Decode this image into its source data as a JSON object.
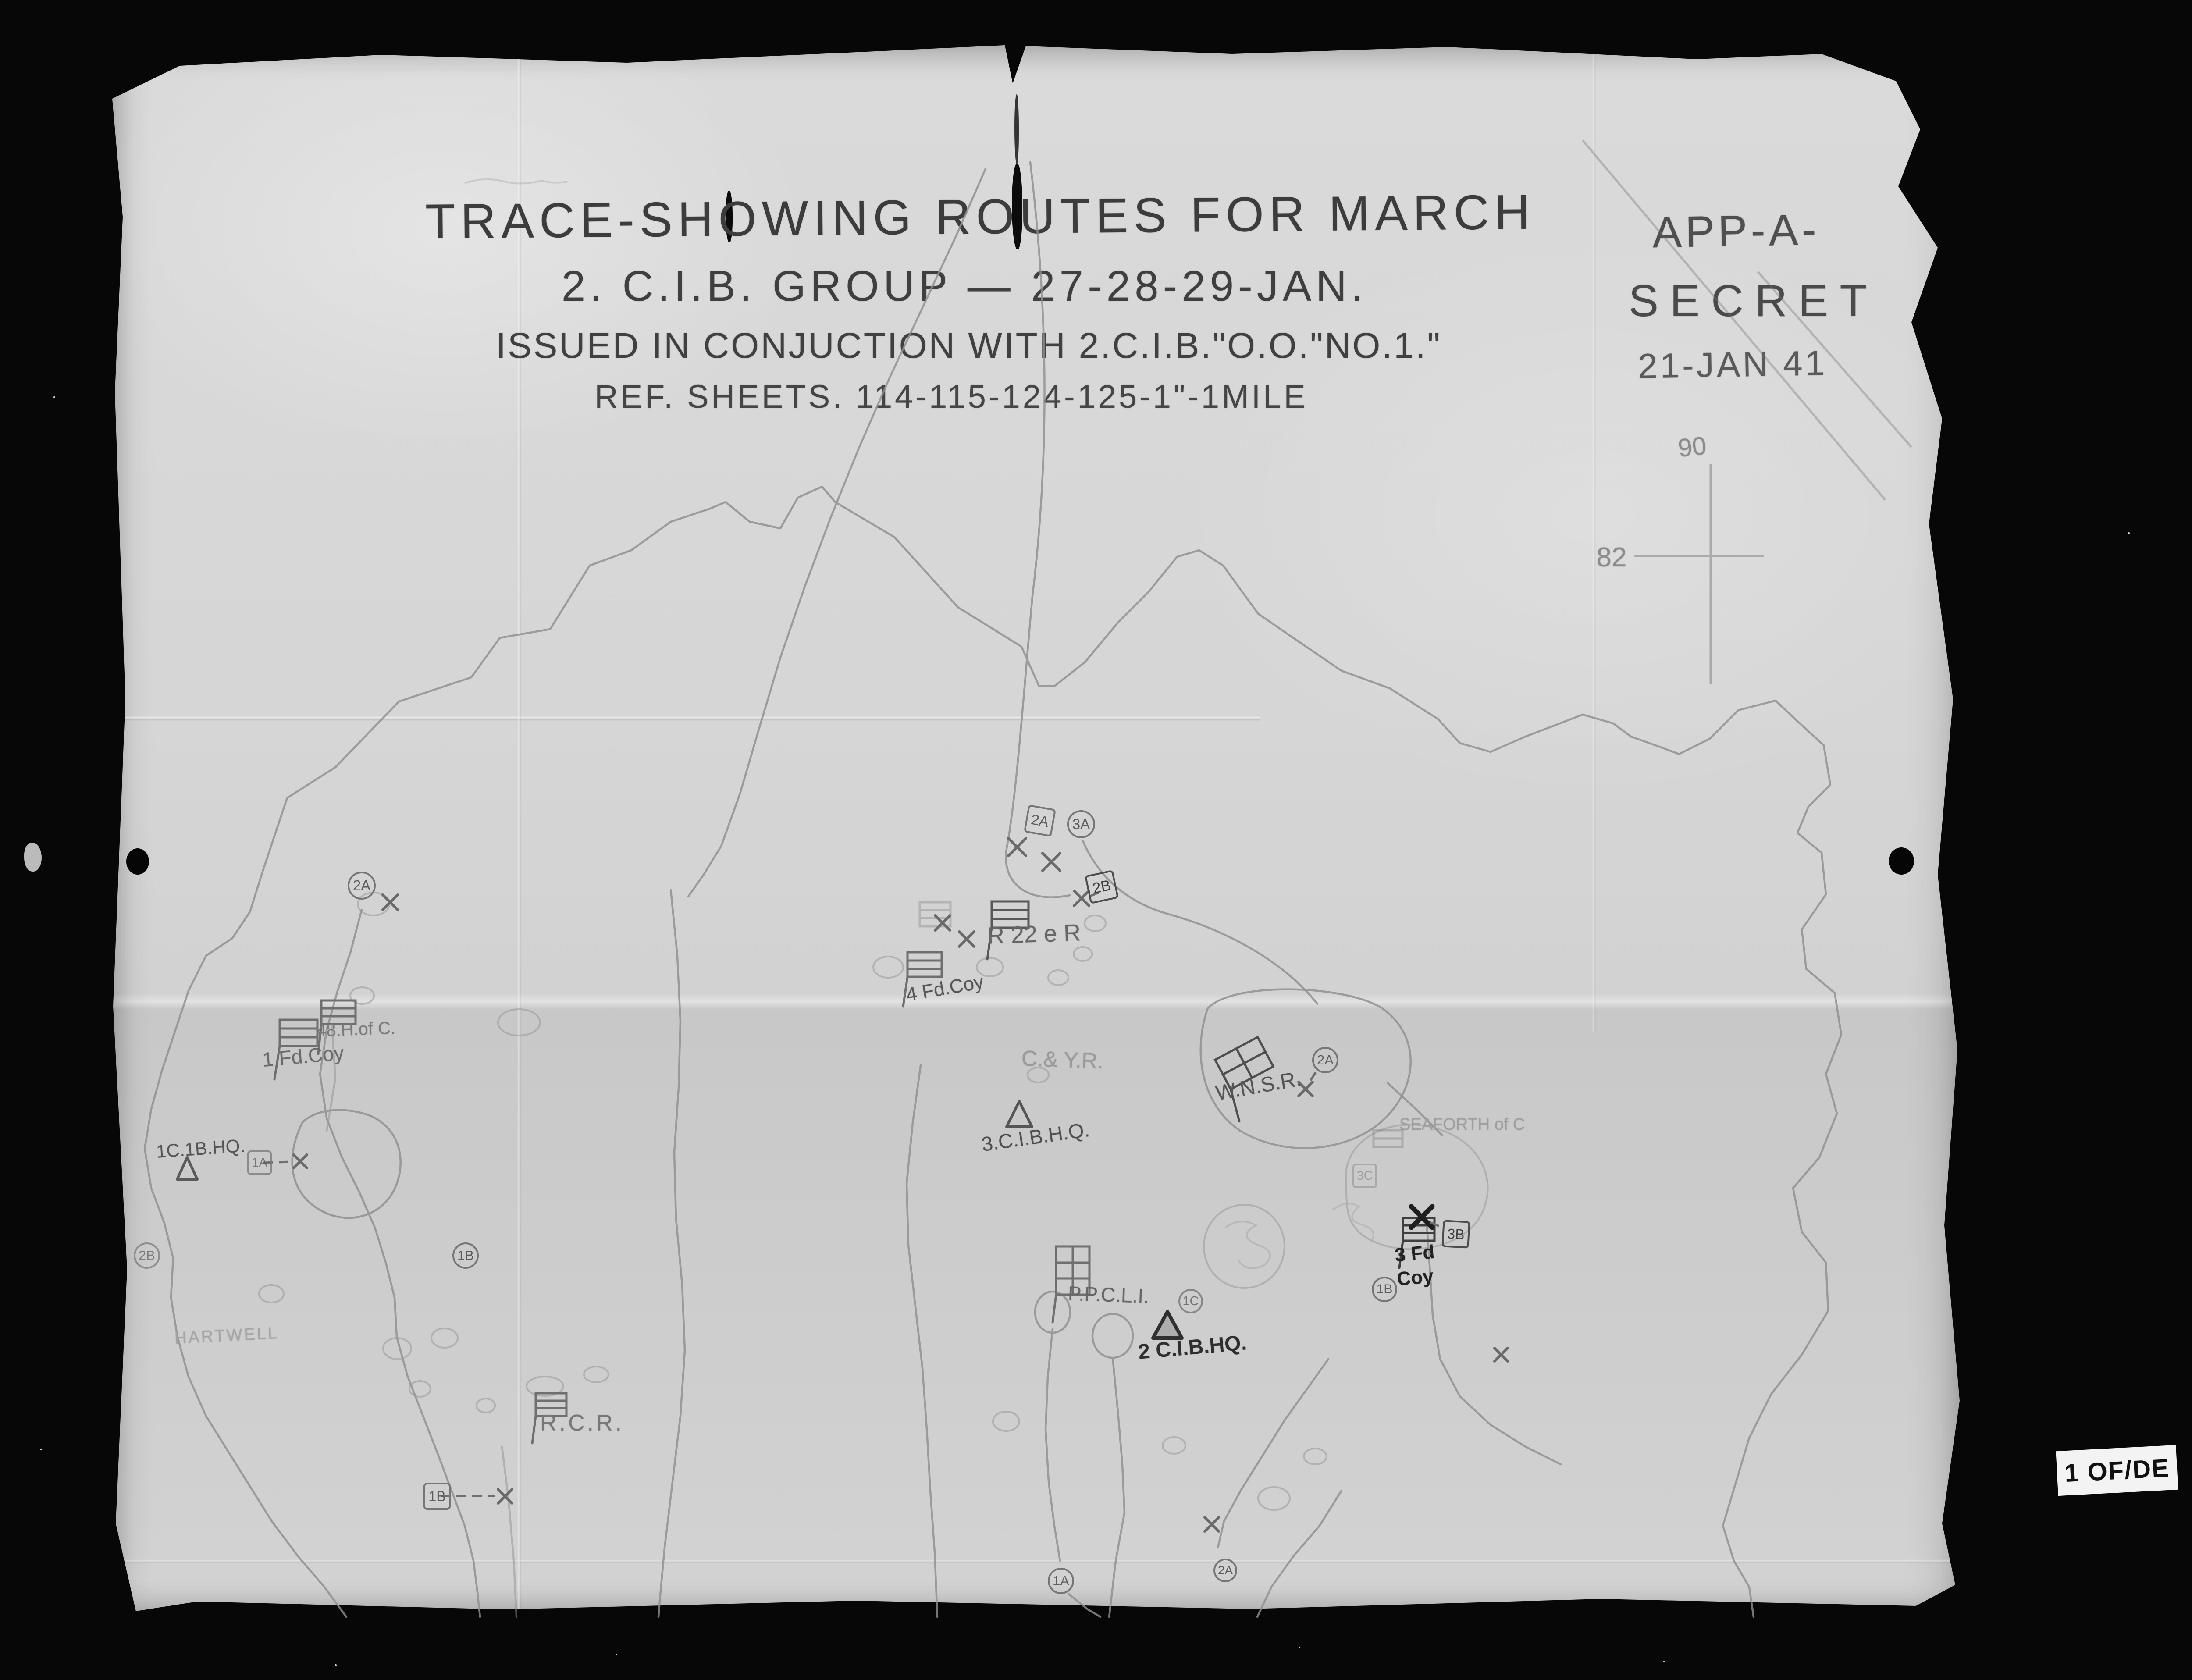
{
  "header": {
    "title_line1": "TRACE-SHOWING ROUTES FOR MARCH",
    "title_line2": "2. C.I.B. GROUP — 27-28-29-JAN.",
    "title_line3": "ISSUED IN CONJUCTION WITH 2.C.I.B.\"O.O.\"NO.1.\"",
    "title_line4": "REF. SHEETS. 114-115-124-125-1\"-1MILE"
  },
  "classification": {
    "appendix": "APP-A-",
    "security": "SECRET",
    "date": "21-JAN 41"
  },
  "grid_reference": {
    "northing": "90",
    "easting": "82"
  },
  "map": {
    "unit_labels": [
      {
        "text": "1 Fd.Coy"
      },
      {
        "text": "48.H.of C."
      },
      {
        "text": "4 Fd.Coy"
      },
      {
        "text": "R 22 e R"
      },
      {
        "text": "C.& Y.R."
      },
      {
        "text": "3.C.I.B.H.Q."
      },
      {
        "text": "W.N.S.R."
      },
      {
        "text": "P.P.C.L.I."
      },
      {
        "text": "2 C.I.B.HQ."
      },
      {
        "text": "R.C.R."
      },
      {
        "text": "3 Fd Coy"
      },
      {
        "text": "1C.1B.HQ."
      },
      {
        "text": "SEAFORTH of C"
      },
      {
        "text": "HARTWELL"
      }
    ],
    "route_markers": [
      {
        "label": "2A",
        "shape": "circle"
      },
      {
        "label": "2A",
        "shape": "box"
      },
      {
        "label": "3A",
        "shape": "circle"
      },
      {
        "label": "2B",
        "shape": "box"
      },
      {
        "label": "2A",
        "shape": "circle"
      },
      {
        "label": "1C",
        "shape": "circle"
      },
      {
        "label": "1B",
        "shape": "circle"
      },
      {
        "label": "3B",
        "shape": "box"
      },
      {
        "label": "2B",
        "shape": "circle"
      },
      {
        "label": "1B",
        "shape": "circle"
      },
      {
        "label": "1A",
        "shape": "box"
      },
      {
        "label": "1B",
        "shape": "box"
      },
      {
        "label": "1A",
        "shape": "circle"
      },
      {
        "label": "2A",
        "shape": "circle"
      },
      {
        "label": "3C",
        "shape": "box"
      }
    ]
  },
  "archival": {
    "frame_number": "000068",
    "frame_digits": [
      "8",
      "6",
      "0",
      "0",
      "0",
      "0"
    ],
    "record_group_line1": "RG 24, C-3, vol. 14069",
    "record_group_line2": "File/dossier 35",
    "defence_line1": "NATIONAL DEFENCE",
    "defence_line2": "DÉFENSE NATIONALE",
    "archives_line1": "National Archives of Canada",
    "archives_line2": "Archives nationales du Canada",
    "page_label": "1 OF/DE"
  },
  "colors": {
    "background": "#070707",
    "paper": "#d4d4d4",
    "pencil": "#8f8f8f",
    "title_ink": "#3c3c3c",
    "strip_white": "#f0f0f0",
    "strip_grey": "#b4b4b4"
  }
}
